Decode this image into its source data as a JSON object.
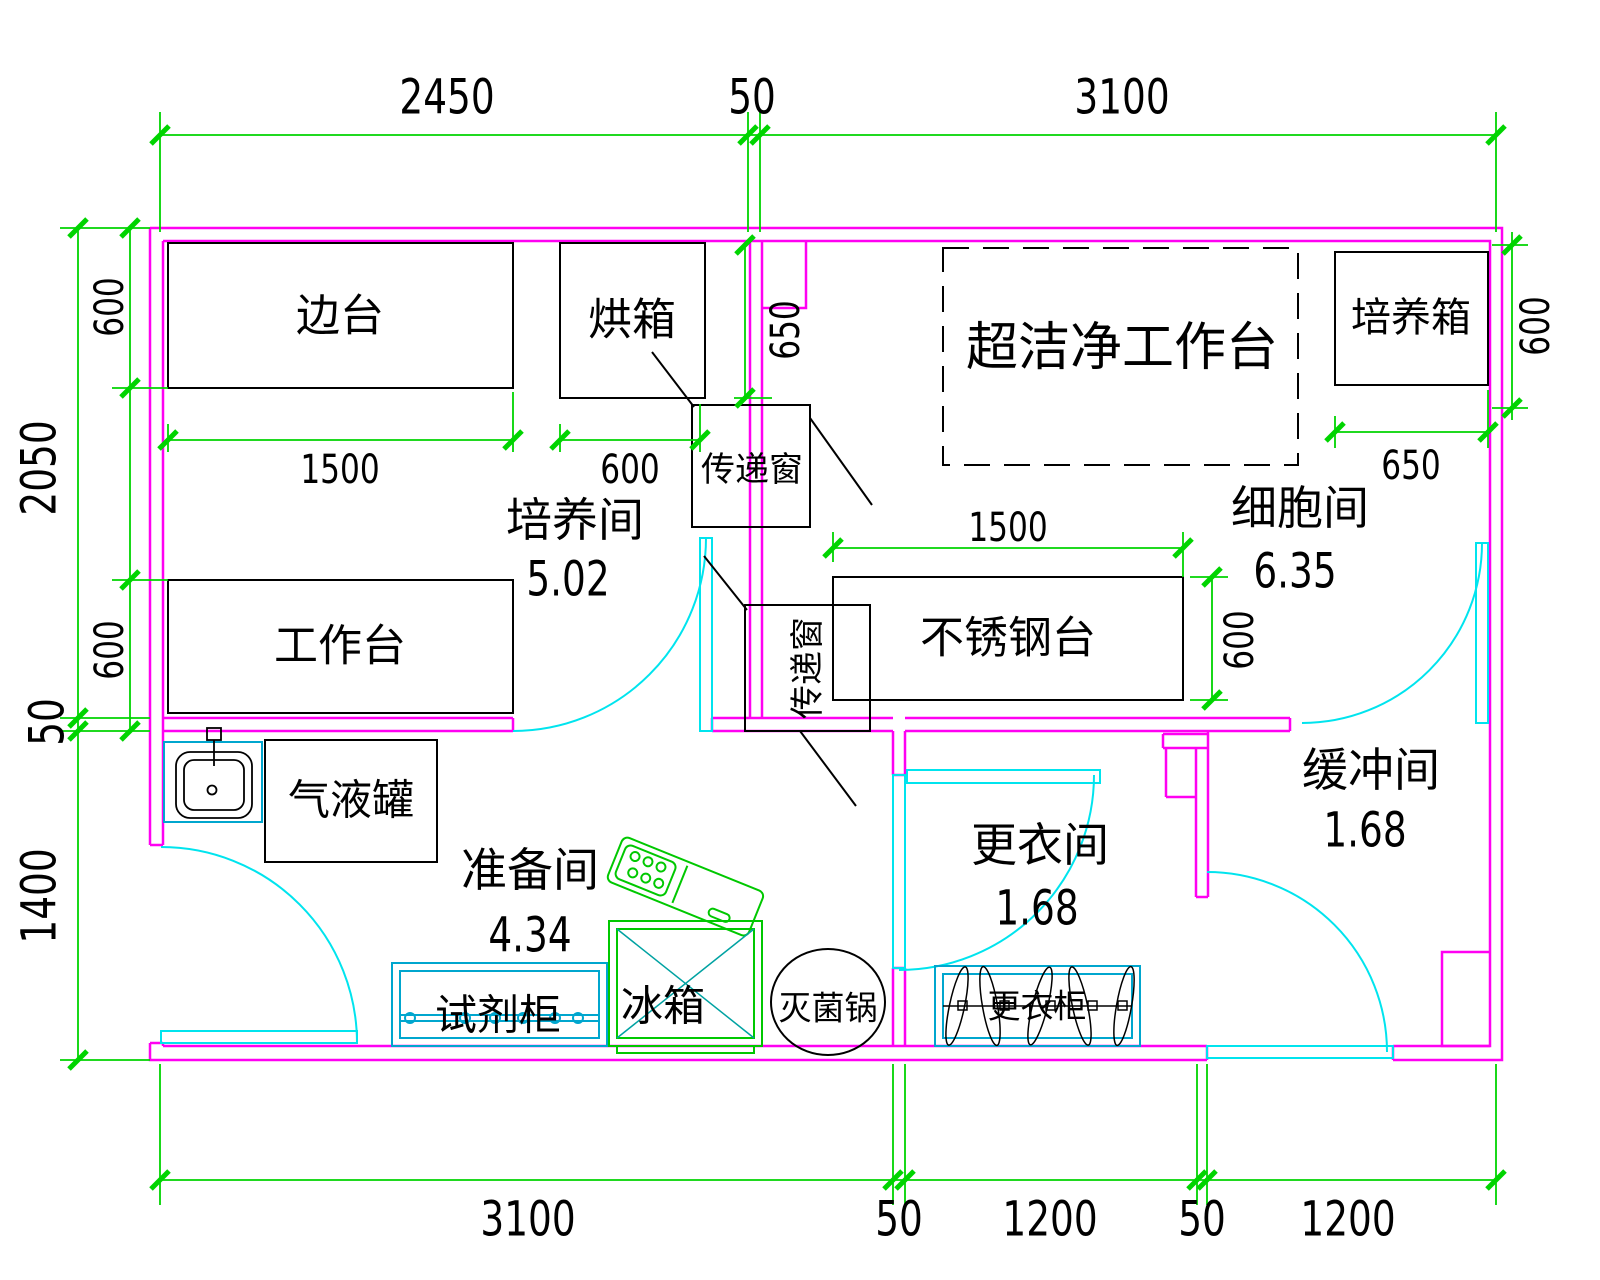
{
  "rooms": [
    {
      "name": "培养间",
      "area": "5.02"
    },
    {
      "name": "细胞间",
      "area": "6.35"
    },
    {
      "name": "准备间",
      "area": "4.34"
    },
    {
      "name": "更衣间",
      "area": "1.68"
    },
    {
      "name": "缓冲间",
      "area": "1.68"
    }
  ],
  "equipment": {
    "side_bench": "边台",
    "oven": "烘箱",
    "pass_window_top": "传递窗",
    "clean_bench": "超洁净工作台",
    "incubator": "培养箱",
    "workbench": "工作台",
    "stainless_table": "不锈钢台",
    "pass_window_mid": "传递窗",
    "gas_liquid_tank": "气液罐",
    "reagent_cabinet": "试剂柜",
    "fridge": "冰箱",
    "sterilizer": "灭菌锅",
    "wardrobe": "更衣柜"
  },
  "dims": {
    "top": [
      "2450",
      "50",
      "3100"
    ],
    "bottom": [
      "3100",
      "50",
      "1200",
      "50",
      "1200"
    ],
    "left": [
      "2050",
      "50",
      "1400"
    ],
    "left_inner": [
      "600",
      "600"
    ],
    "right": [
      "600"
    ],
    "internal": {
      "bench_w": "1500",
      "oven_w": "600",
      "passbox_offset": "650",
      "incubator_w": "650",
      "steel_w": "1500",
      "steel_d": "600"
    }
  },
  "colors": {
    "wall": "#FF00F2",
    "dimension": "#00D400",
    "door": "#00E4EE",
    "cabinet": "#00A6CE",
    "appliance": "#00C800",
    "hatch": "#00A2A2",
    "line": "#000000",
    "background": "#FFFFFF"
  }
}
